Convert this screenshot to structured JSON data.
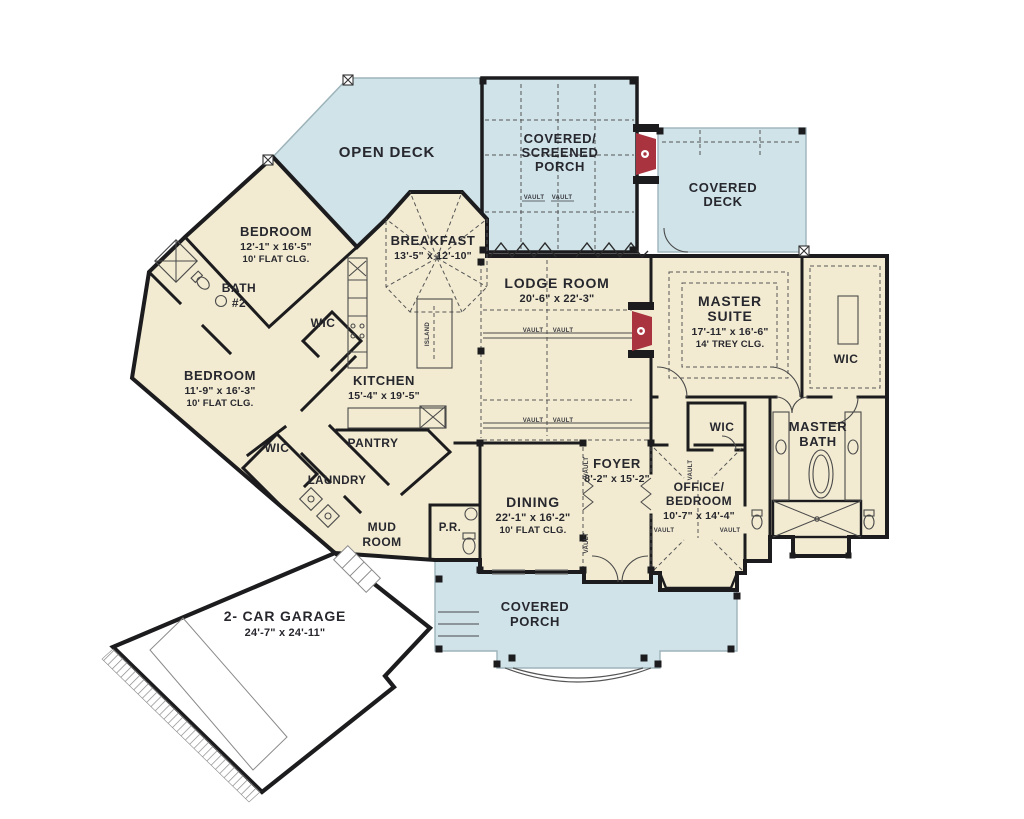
{
  "plan": {
    "colors": {
      "floor": "#f2ebd1",
      "deck": "#cfe3e9",
      "fireplace": "#a93440",
      "wall": "#1c1c1e",
      "text": "#27272e"
    },
    "rooms": {
      "open_deck": {
        "name": "OPEN DECK"
      },
      "screened_porch": {
        "name1": "COVERED/",
        "name2": "SCREENED",
        "name3": "PORCH"
      },
      "covered_deck": {
        "name1": "COVERED",
        "name2": "DECK"
      },
      "bedroom_top": {
        "name": "BEDROOM",
        "dims": "12'-1\" x 16'-5\"",
        "ceiling": "10' FLAT CLG."
      },
      "bath_2": {
        "name1": "BATH",
        "name2": "#2"
      },
      "wic_bedroom_top": {
        "name": "WIC"
      },
      "breakfast": {
        "name": "BREAKFAST",
        "dims": "13'-5\" x 12'-10\""
      },
      "lodge_room": {
        "name": "LODGE ROOM",
        "dims": "20'-6\" x 22'-3\""
      },
      "master_suite": {
        "name1": "MASTER",
        "name2": "SUITE",
        "dims": "17'-11\" x 16'-6\"",
        "ceiling": "14' TREY CLG."
      },
      "wic_master": {
        "name": "WIC"
      },
      "bedroom_left": {
        "name": "BEDROOM",
        "dims": "11'-9\" x 16'-3\"",
        "ceiling": "10' FLAT CLG."
      },
      "kitchen": {
        "name": "KITCHEN",
        "dims": "15'-4\" x 19'-5\""
      },
      "wic_bedroom_left": {
        "name": "WIC"
      },
      "pantry": {
        "name": "PANTRY"
      },
      "laundry": {
        "name": "LAUNDRY"
      },
      "mud_room": {
        "name1": "MUD",
        "name2": "ROOM"
      },
      "powder_room": {
        "name": "P.R."
      },
      "dining": {
        "name": "DINING",
        "dims": "22'-1\" x 16'-2\"",
        "ceiling": "10' FLAT CLG."
      },
      "foyer": {
        "name": "FOYER",
        "dims": "8'-2\" x 15'-2\""
      },
      "office_bedroom": {
        "name1": "OFFICE/",
        "name2": "BEDROOM",
        "dims": "10'-7\" x 14'-4\""
      },
      "wic_office": {
        "name": "WIC"
      },
      "master_bath": {
        "name1": "MASTER",
        "name2": "BATH"
      },
      "covered_porch": {
        "name1": "COVERED",
        "name2": "PORCH"
      },
      "garage": {
        "name": "2- CAR GARAGE",
        "dims": "24'-7\" x 24'-11\""
      }
    },
    "annotations": {
      "vault": "VAULT",
      "island": "ISLAND"
    }
  }
}
